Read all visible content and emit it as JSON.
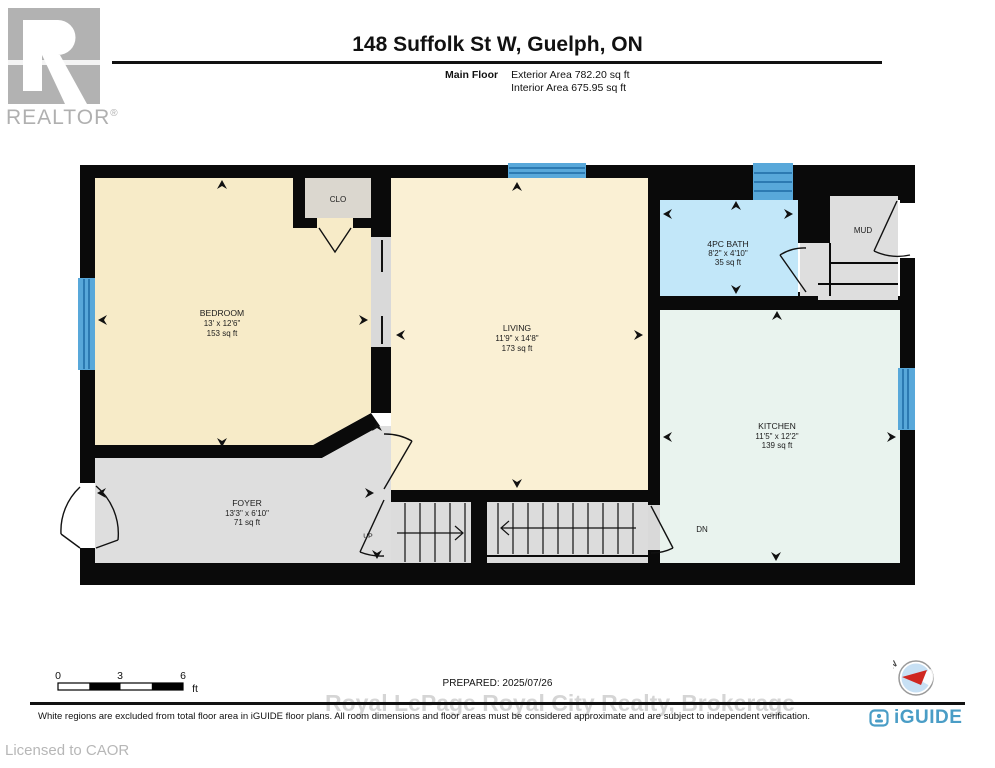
{
  "header": {
    "brand_logo": "REALTOR",
    "brand_mark": "®",
    "title": "148 Suffolk St W, Guelph, ON",
    "floor_label": "Main Floor",
    "exterior_area": "Exterior Area 782.20 sq ft",
    "interior_area": "Interior Area 675.95 sq ft"
  },
  "plan": {
    "rooms": [
      {
        "name": "BEDROOM",
        "dims": "13' x 12'6\"",
        "area": "153 sq ft"
      },
      {
        "name": "LIVING",
        "dims": "11'9\" x 14'8\"",
        "area": "173 sq ft"
      },
      {
        "name": "4PC BATH",
        "dims": "8'2\" x 4'10\"",
        "area": "35 sq ft"
      },
      {
        "name": "KITCHEN",
        "dims": "11'5\" x 12'2\"",
        "area": "139 sq ft"
      },
      {
        "name": "FOYER",
        "dims": "13'3\" x 6'10\"",
        "area": "71 sq ft"
      },
      {
        "name": "CLO"
      },
      {
        "name": "MUD"
      }
    ],
    "stairs_up": "UP",
    "stairs_down": "DN",
    "compass_label": "N"
  },
  "scale_bar": {
    "tick_0": "0",
    "tick_3": "3",
    "tick_6": "6",
    "unit": "ft"
  },
  "footer": {
    "prepared": "PREPARED: 2025/07/26",
    "watermark": "Royal LePage Royal City Realty, Brokerage",
    "disclaimer": "White regions are excluded from total floor area in iGUIDE floor plans. All room dimensions and floor areas must be considered approximate and are subject to independent verification.",
    "brand": "iGUIDE",
    "licensed_to": "Licensed to CAOR"
  },
  "colors": {
    "wall": "#0a0a0a",
    "bedroom_fill": "#f7ebc8",
    "living_fill": "#faf0d4",
    "bath_fill": "#c2e7f9",
    "kitchen_fill": "#e9f3ee",
    "gray_fill": "#dedede",
    "closet_fill": "#dbd7cf",
    "window_blue": "#58a8da",
    "window_line": "#1d6aa5",
    "iguide_blue": "#4a9dc6",
    "compass_red": "#cf2721",
    "realtor_gray": "#b2b2b2",
    "watermark_gray": "#c0c0c0"
  }
}
